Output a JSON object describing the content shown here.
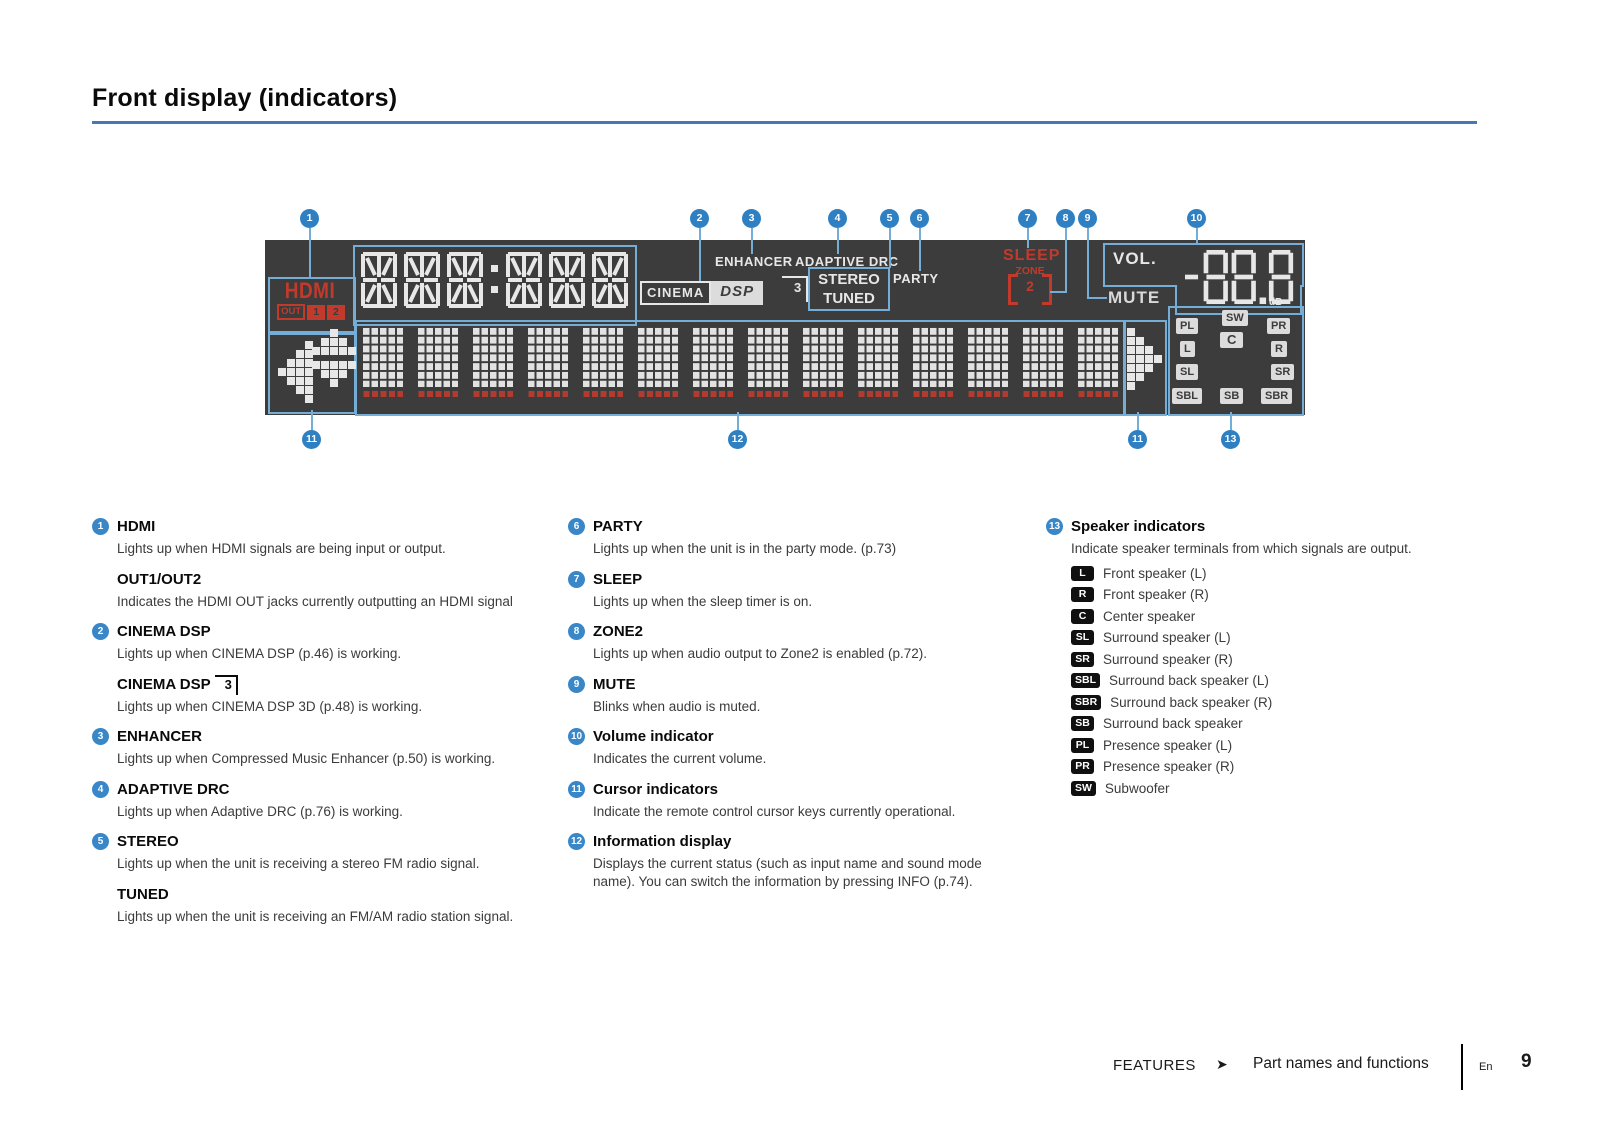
{
  "page": {
    "title": "Front display (indicators)"
  },
  "callouts": [
    "1",
    "2",
    "3",
    "4",
    "5",
    "6",
    "7",
    "8",
    "9",
    "10",
    "11",
    "12",
    "13"
  ],
  "display": {
    "hdmi": "HDMI",
    "out": "OUT",
    "out1": "1",
    "out2": "2",
    "enhancer": "ENHANCER",
    "adaptive_drc": "ADAPTIVE DRC",
    "cinema": "CINEMA",
    "dsp": "DSP",
    "dsp_3d": "3",
    "stereo": "STEREO",
    "tuned": "TUNED",
    "party": "PARTY",
    "sleep": "SLEEP",
    "zone": "ZONE",
    "zone2_number": "2",
    "mute": "MUTE",
    "vol_label": "VOL.",
    "volume_value": "-88.8",
    "db_label": "dB",
    "speaker_grid": {
      "pl": "PL",
      "l": "L",
      "sl": "SL",
      "sbl": "SBL",
      "sw": "SW",
      "c": "C",
      "sb": "SB",
      "pr": "PR",
      "r": "R",
      "sr": "SR",
      "sbr": "SBR"
    }
  },
  "col1": {
    "items": [
      {
        "num": "1",
        "heading": "HDMI",
        "body": "Lights up when HDMI signals are being input or output.",
        "sub_heading": "OUT1/OUT2",
        "sub_body": "Indicates the HDMI OUT jacks currently outputting an HDMI signal"
      },
      {
        "num": "2",
        "heading": "CINEMA DSP",
        "body": "Lights up when CINEMA DSP (p.46) is working.",
        "sub_heading": "CINEMA DSP",
        "sub_glyph": "3",
        "sub_body": "Lights up when CINEMA DSP 3D (p.48) is working."
      },
      {
        "num": "3",
        "heading": "ENHANCER",
        "body": "Lights up when Compressed Music Enhancer (p.50) is working."
      },
      {
        "num": "4",
        "heading": "ADAPTIVE DRC",
        "body": "Lights up when Adaptive DRC (p.76) is working."
      },
      {
        "num": "5",
        "heading": "STEREO",
        "body": "Lights up when the unit is receiving a stereo FM radio signal.",
        "sub_heading": "TUNED",
        "sub_body": "Lights up when the unit is receiving an FM/AM radio station signal."
      }
    ]
  },
  "col2": {
    "items": [
      {
        "num": "6",
        "heading": "PARTY",
        "body": "Lights up when the unit is in the party mode. (p.73)"
      },
      {
        "num": "7",
        "heading": "SLEEP",
        "body": "Lights up when the sleep timer is on."
      },
      {
        "num": "8",
        "heading": "ZONE2",
        "body": "Lights up when audio output to Zone2 is enabled (p.72)."
      },
      {
        "num": "9",
        "heading": "MUTE",
        "body": "Blinks when audio is muted."
      },
      {
        "num": "10",
        "heading": "Volume indicator",
        "body": "Indicates the current volume."
      },
      {
        "num": "11",
        "heading": "Cursor indicators",
        "body": "Indicate the remote control cursor keys currently operational."
      },
      {
        "num": "12",
        "heading": "Information display",
        "body": "Displays the current status (such as input name and sound mode name). You can switch the information by pressing INFO (p.74)."
      }
    ]
  },
  "col3": {
    "num": "13",
    "heading": "Speaker indicators",
    "body": "Indicate speaker terminals from which signals are output.",
    "speakers": [
      {
        "badge": "L",
        "label": "Front speaker (L)"
      },
      {
        "badge": "R",
        "label": "Front speaker (R)"
      },
      {
        "badge": "C",
        "label": "Center speaker"
      },
      {
        "badge": "SL",
        "label": "Surround speaker (L)"
      },
      {
        "badge": "SR",
        "label": "Surround speaker (R)"
      },
      {
        "badge": "SBL",
        "label": "Surround back speaker (L)"
      },
      {
        "badge": "SBR",
        "label": "Surround back speaker (R)"
      },
      {
        "badge": "SB",
        "label": "Surround back speaker"
      },
      {
        "badge": "PL",
        "label": "Presence speaker (L)"
      },
      {
        "badge": "PR",
        "label": "Presence speaker (R)"
      },
      {
        "badge": "SW",
        "label": "Subwoofer"
      }
    ]
  },
  "footer": {
    "section": "FEATURES",
    "arrow": "➤",
    "subsection": "Part names and functions",
    "lang": "En",
    "page_number": "9"
  }
}
